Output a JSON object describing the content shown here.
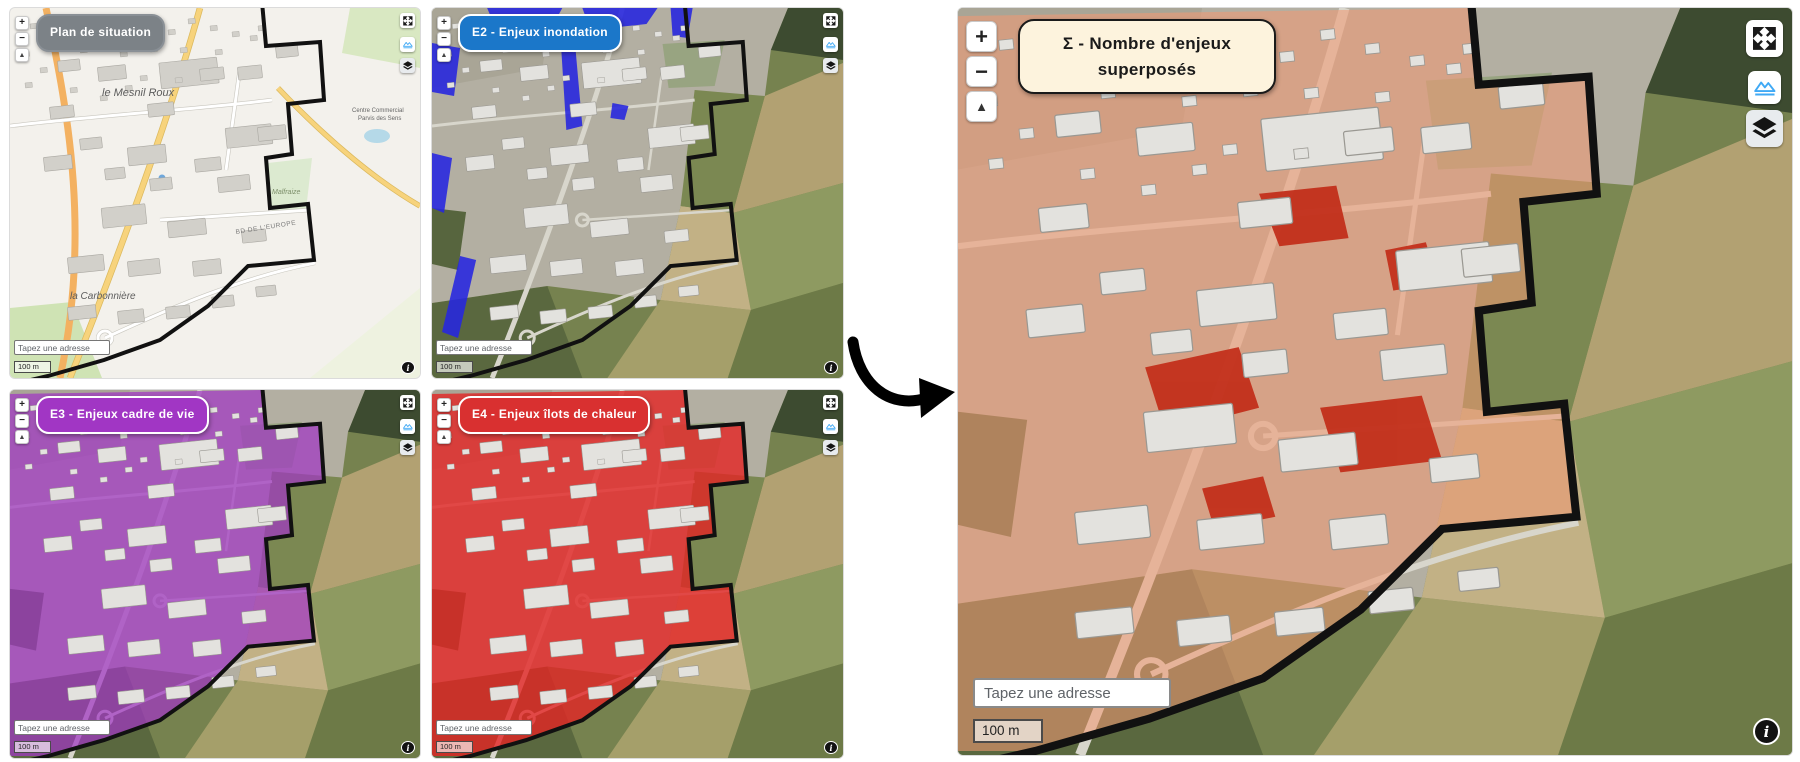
{
  "panels": [
    {
      "id": "plan",
      "title": "Plan de situation",
      "label_bg": "#7c8287",
      "label_text": "#ffffff",
      "label_border": "#8a9096",
      "map_style": "plan",
      "overlay_color": "none",
      "size": "small"
    },
    {
      "id": "e2",
      "title": "E2 - Enjeux inondation",
      "label_bg": "#1b77c9",
      "label_text": "#ffffff",
      "label_border": "#ffffff",
      "map_style": "aerial",
      "overlay_color": "#2525e0",
      "size": "small"
    },
    {
      "id": "e3",
      "title": "E3 - Enjeux cadre de vie",
      "label_bg": "#a136c4",
      "label_text": "#ffffff",
      "label_border": "#ffffff",
      "map_style": "aerial",
      "overlay_color": "#a136c4",
      "size": "small"
    },
    {
      "id": "e4",
      "title": "E4 - Enjeux îlots de chaleur",
      "label_bg": "#d93030",
      "label_text": "#ffffff",
      "label_border": "#ffffff",
      "map_style": "aerial",
      "overlay_color": "#e32424",
      "size": "small"
    },
    {
      "id": "sum",
      "title": "Σ - Nombre d'enjeux superposés",
      "label_bg": "#fdf3dd",
      "label_text": "#1a1a1a",
      "label_border": "#1a1a1a",
      "map_style": "aerial",
      "overlay_color": "#ef9a74",
      "size": "large"
    }
  ],
  "controls": {
    "zoom_in": "+",
    "zoom_out": "−",
    "tilt": "▲",
    "info": "i"
  },
  "search": {
    "placeholder": "Tapez une adresse"
  },
  "scale": {
    "label": "100 m"
  },
  "map_labels": {
    "town": "le Mesnil Roux",
    "hamlet": "la Carbonnière",
    "street": "BD DE L'EUROPE",
    "area": "Malfraize",
    "mall_line1": "Centre Commercial",
    "mall_line2": "Parvis des Sens"
  },
  "colors": {
    "flood_overlay": "#2525e0",
    "livability_overlay": "#a136c4",
    "heat_overlay": "#e32424",
    "sum_overlay": "#ef9a74",
    "sum_hotspot": "#c22c18",
    "boundary": "#111111"
  }
}
